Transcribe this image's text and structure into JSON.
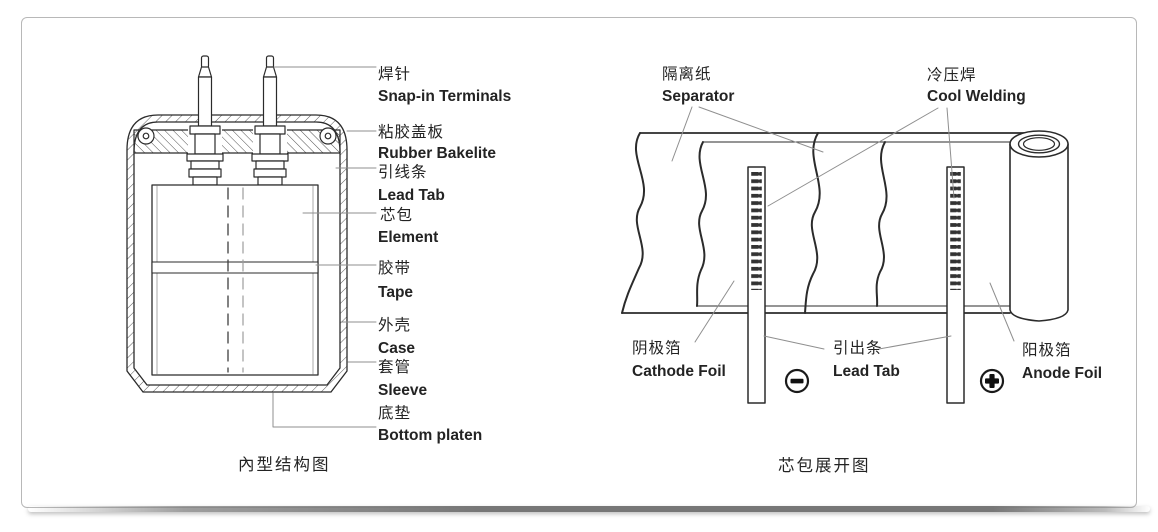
{
  "colors": {
    "line": "#2b2b2b",
    "leader": "#8f8f8f",
    "text": "#232323",
    "card_border": "#b8b8b8",
    "shadow_bar": "#777777"
  },
  "left_diagram": {
    "caption": "內型结构图",
    "labels": [
      {
        "zh": "焊针",
        "en": "Snap-in Terminals"
      },
      {
        "zh": "粘胶盖板",
        "en": "Rubber Bakelite"
      },
      {
        "zh": "引线条",
        "en": "Lead Tab"
      },
      {
        "zh": "芯包",
        "en": "Element"
      },
      {
        "zh": "胶带",
        "en": "Tape"
      },
      {
        "zh": "外壳",
        "en": "Case"
      },
      {
        "zh": "套管",
        "en": "Sleeve"
      },
      {
        "zh": "底垫",
        "en": "Bottom platen"
      }
    ]
  },
  "right_diagram": {
    "caption": "芯包展开图",
    "labels": [
      {
        "zh": "隔离纸",
        "en": "Separator"
      },
      {
        "zh": "冷压焊",
        "en": "Cool Welding"
      },
      {
        "zh": "阴极箔",
        "en": "Cathode Foil"
      },
      {
        "zh": "引出条",
        "en": "Lead Tab"
      },
      {
        "zh": "阳极箔",
        "en": "Anode Foil"
      }
    ],
    "icons": {
      "negative_terminal": "minus-in-circle-icon",
      "positive_terminal": "plus-in-circle-icon"
    }
  }
}
